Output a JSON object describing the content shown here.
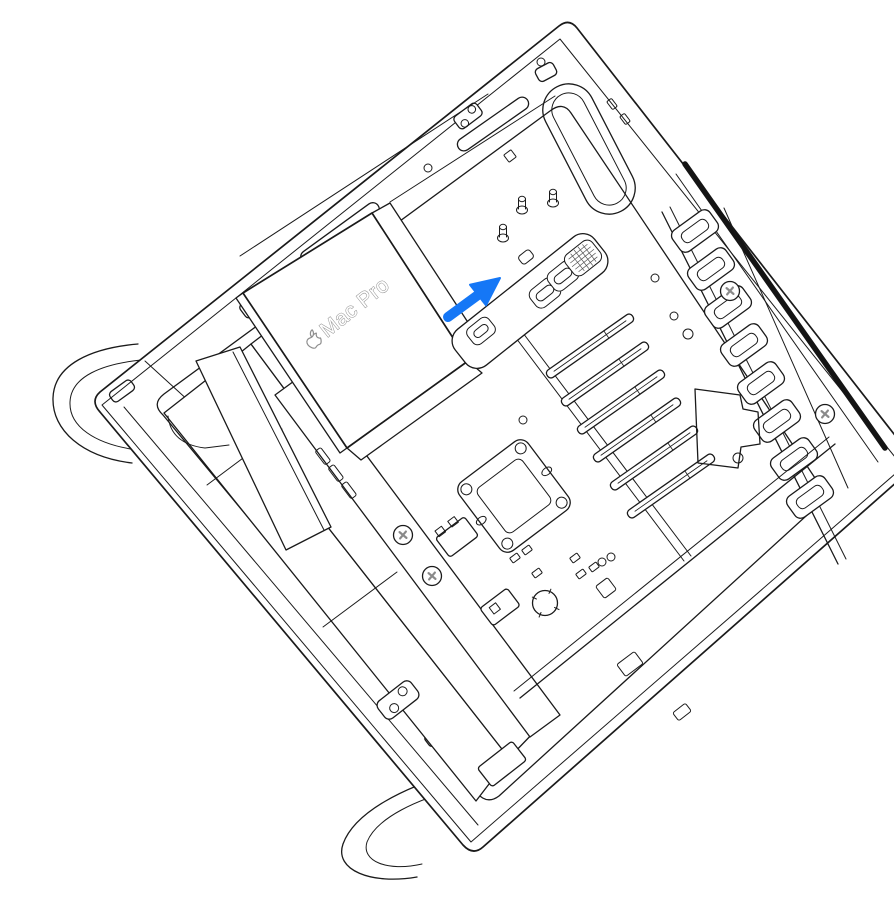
{
  "figure": {
    "description": "Technical line illustration of a Mac Pro tower lying on its side with the housing removed, showing the power supply cover, logic board, PCIe slots and slot covers. A blue arrow points up and to the right toward the top port opening.",
    "device_label": "Mac Pro",
    "arrow": {
      "direction": "up-right"
    }
  },
  "icons": {
    "apple_logo": "apple-logo",
    "direction_arrow": "arrow-up-right"
  },
  "colors": {
    "background": "#ffffff",
    "line": "#1a1a1a",
    "label_outline": "#8e8e8e",
    "arrow_blue": "#1577f6",
    "dark_slot": "#141414",
    "screw_gray": "#8a8a8a"
  }
}
